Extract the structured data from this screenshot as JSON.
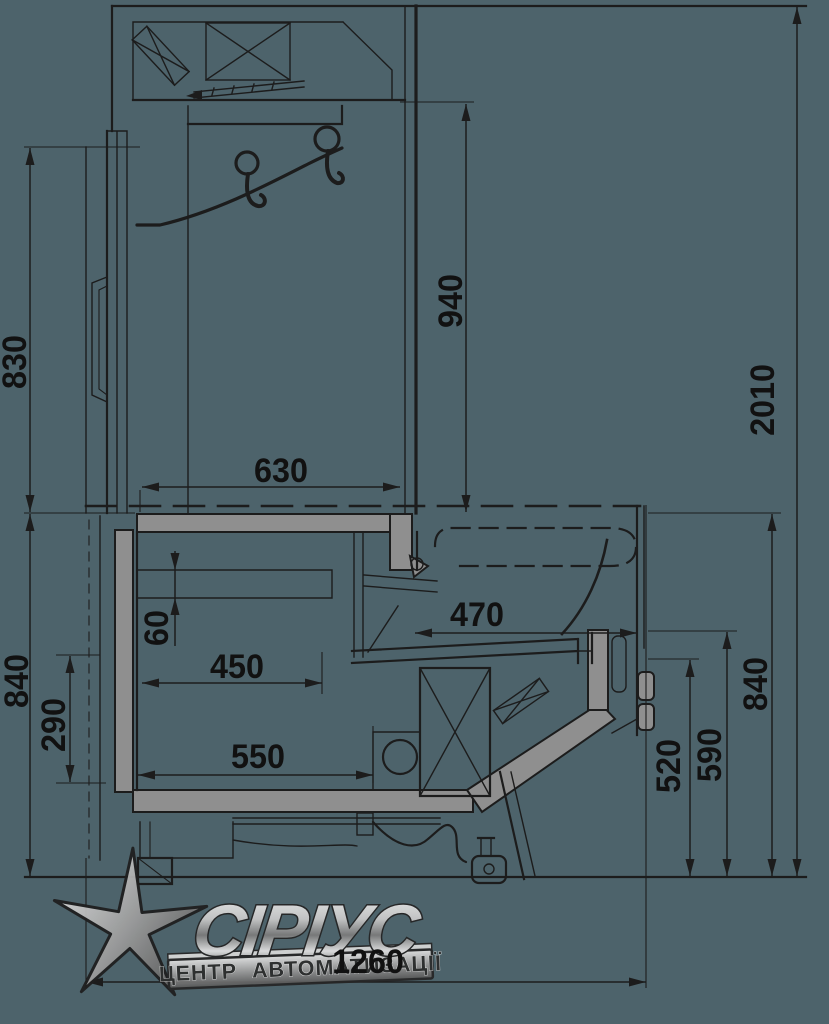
{
  "palette": {
    "background": "#4d636b",
    "line_color": "#1c1c1c",
    "panel_gray": "#8f8f8f",
    "dim_text_color": "#111111"
  },
  "drawing": {
    "type": "technical-cross-section",
    "subject": "refrigerated-display-case-side-section",
    "dimensions": {
      "overall_height": "2010",
      "overall_depth": "1260",
      "rear_upper_height": "830",
      "inner_upper_height": "940",
      "upper_depth": "630",
      "lower_rear_height": "840",
      "well_depth_offset": "60",
      "well_width": "450",
      "lower_inner_height": "290",
      "base_width": "550",
      "deck_width": "470",
      "front_height_small": "520",
      "front_height_mid": "590",
      "front_overall_height": "840"
    },
    "dim_labels": [
      {
        "value": "830",
        "x": 14,
        "y": 362,
        "rot": -90
      },
      {
        "value": "940",
        "x": 450,
        "y": 301,
        "rot": -90
      },
      {
        "value": "2010",
        "x": 762,
        "y": 400,
        "rot": -90
      },
      {
        "value": "630",
        "x": 281,
        "y": 470,
        "rot": 0
      },
      {
        "value": "840",
        "x": 16,
        "y": 681,
        "rot": -90
      },
      {
        "value": "290",
        "x": 53,
        "y": 725,
        "rot": -90
      },
      {
        "value": "60",
        "x": 156,
        "y": 628,
        "rot": -90
      },
      {
        "value": "450",
        "x": 237,
        "y": 666,
        "rot": 0
      },
      {
        "value": "550",
        "x": 258,
        "y": 756,
        "rot": 0
      },
      {
        "value": "470",
        "x": 477,
        "y": 614,
        "rot": 0
      },
      {
        "value": "520",
        "x": 668,
        "y": 766,
        "rot": -90
      },
      {
        "value": "590",
        "x": 709,
        "y": 755,
        "rot": -90
      },
      {
        "value": "840",
        "x": 755,
        "y": 684,
        "rot": -90
      },
      {
        "value": "1260",
        "x": 368,
        "y": 961,
        "rot": 0
      }
    ]
  },
  "watermark": {
    "brand": "СІРІУС",
    "tagline": "ЦЕНТР АВТОМАТИЗАЦІЇ"
  }
}
